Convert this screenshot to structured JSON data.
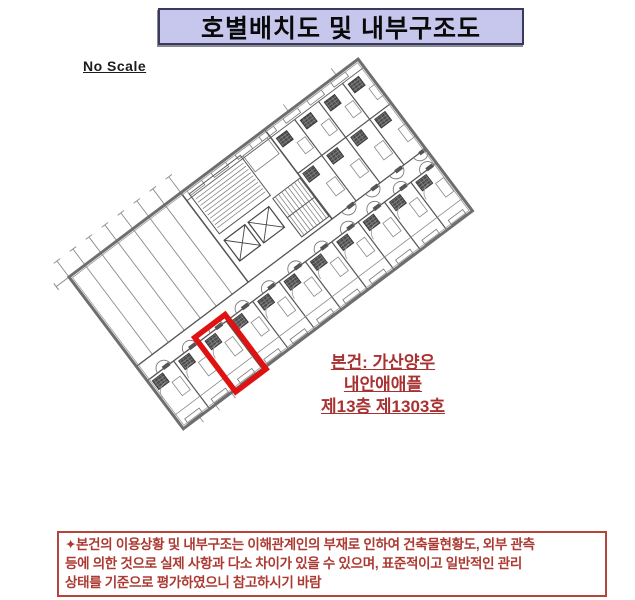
{
  "header": {
    "title": "호별배치도 및 내부구조도",
    "bg_color": "#c7c7ee",
    "border_color": "#3a3a5e"
  },
  "scale_note": "No Scale",
  "plan": {
    "highlight_color": "#e01111",
    "line_color": "#5b5b5b",
    "annotation": {
      "color": "#a83232",
      "lines": [
        "본건: 가산양우",
        "내안애애플",
        "제13층 제1303호"
      ]
    }
  },
  "footnote": {
    "border_color": "#b8453c",
    "text_color": "#ac3a32",
    "lines": [
      "✦본건의 이용상황 및 내부구조는 이해관계인의 부재로 인하여 건축물현황도, 외부 관측",
      "등에 의한 것으로 실제 사항과 다소 차이가 있을 수 있으며, 표준적이고 일반적인 관리",
      "상태를 기준으로 평가하였으니 참고하시기 바람"
    ]
  }
}
